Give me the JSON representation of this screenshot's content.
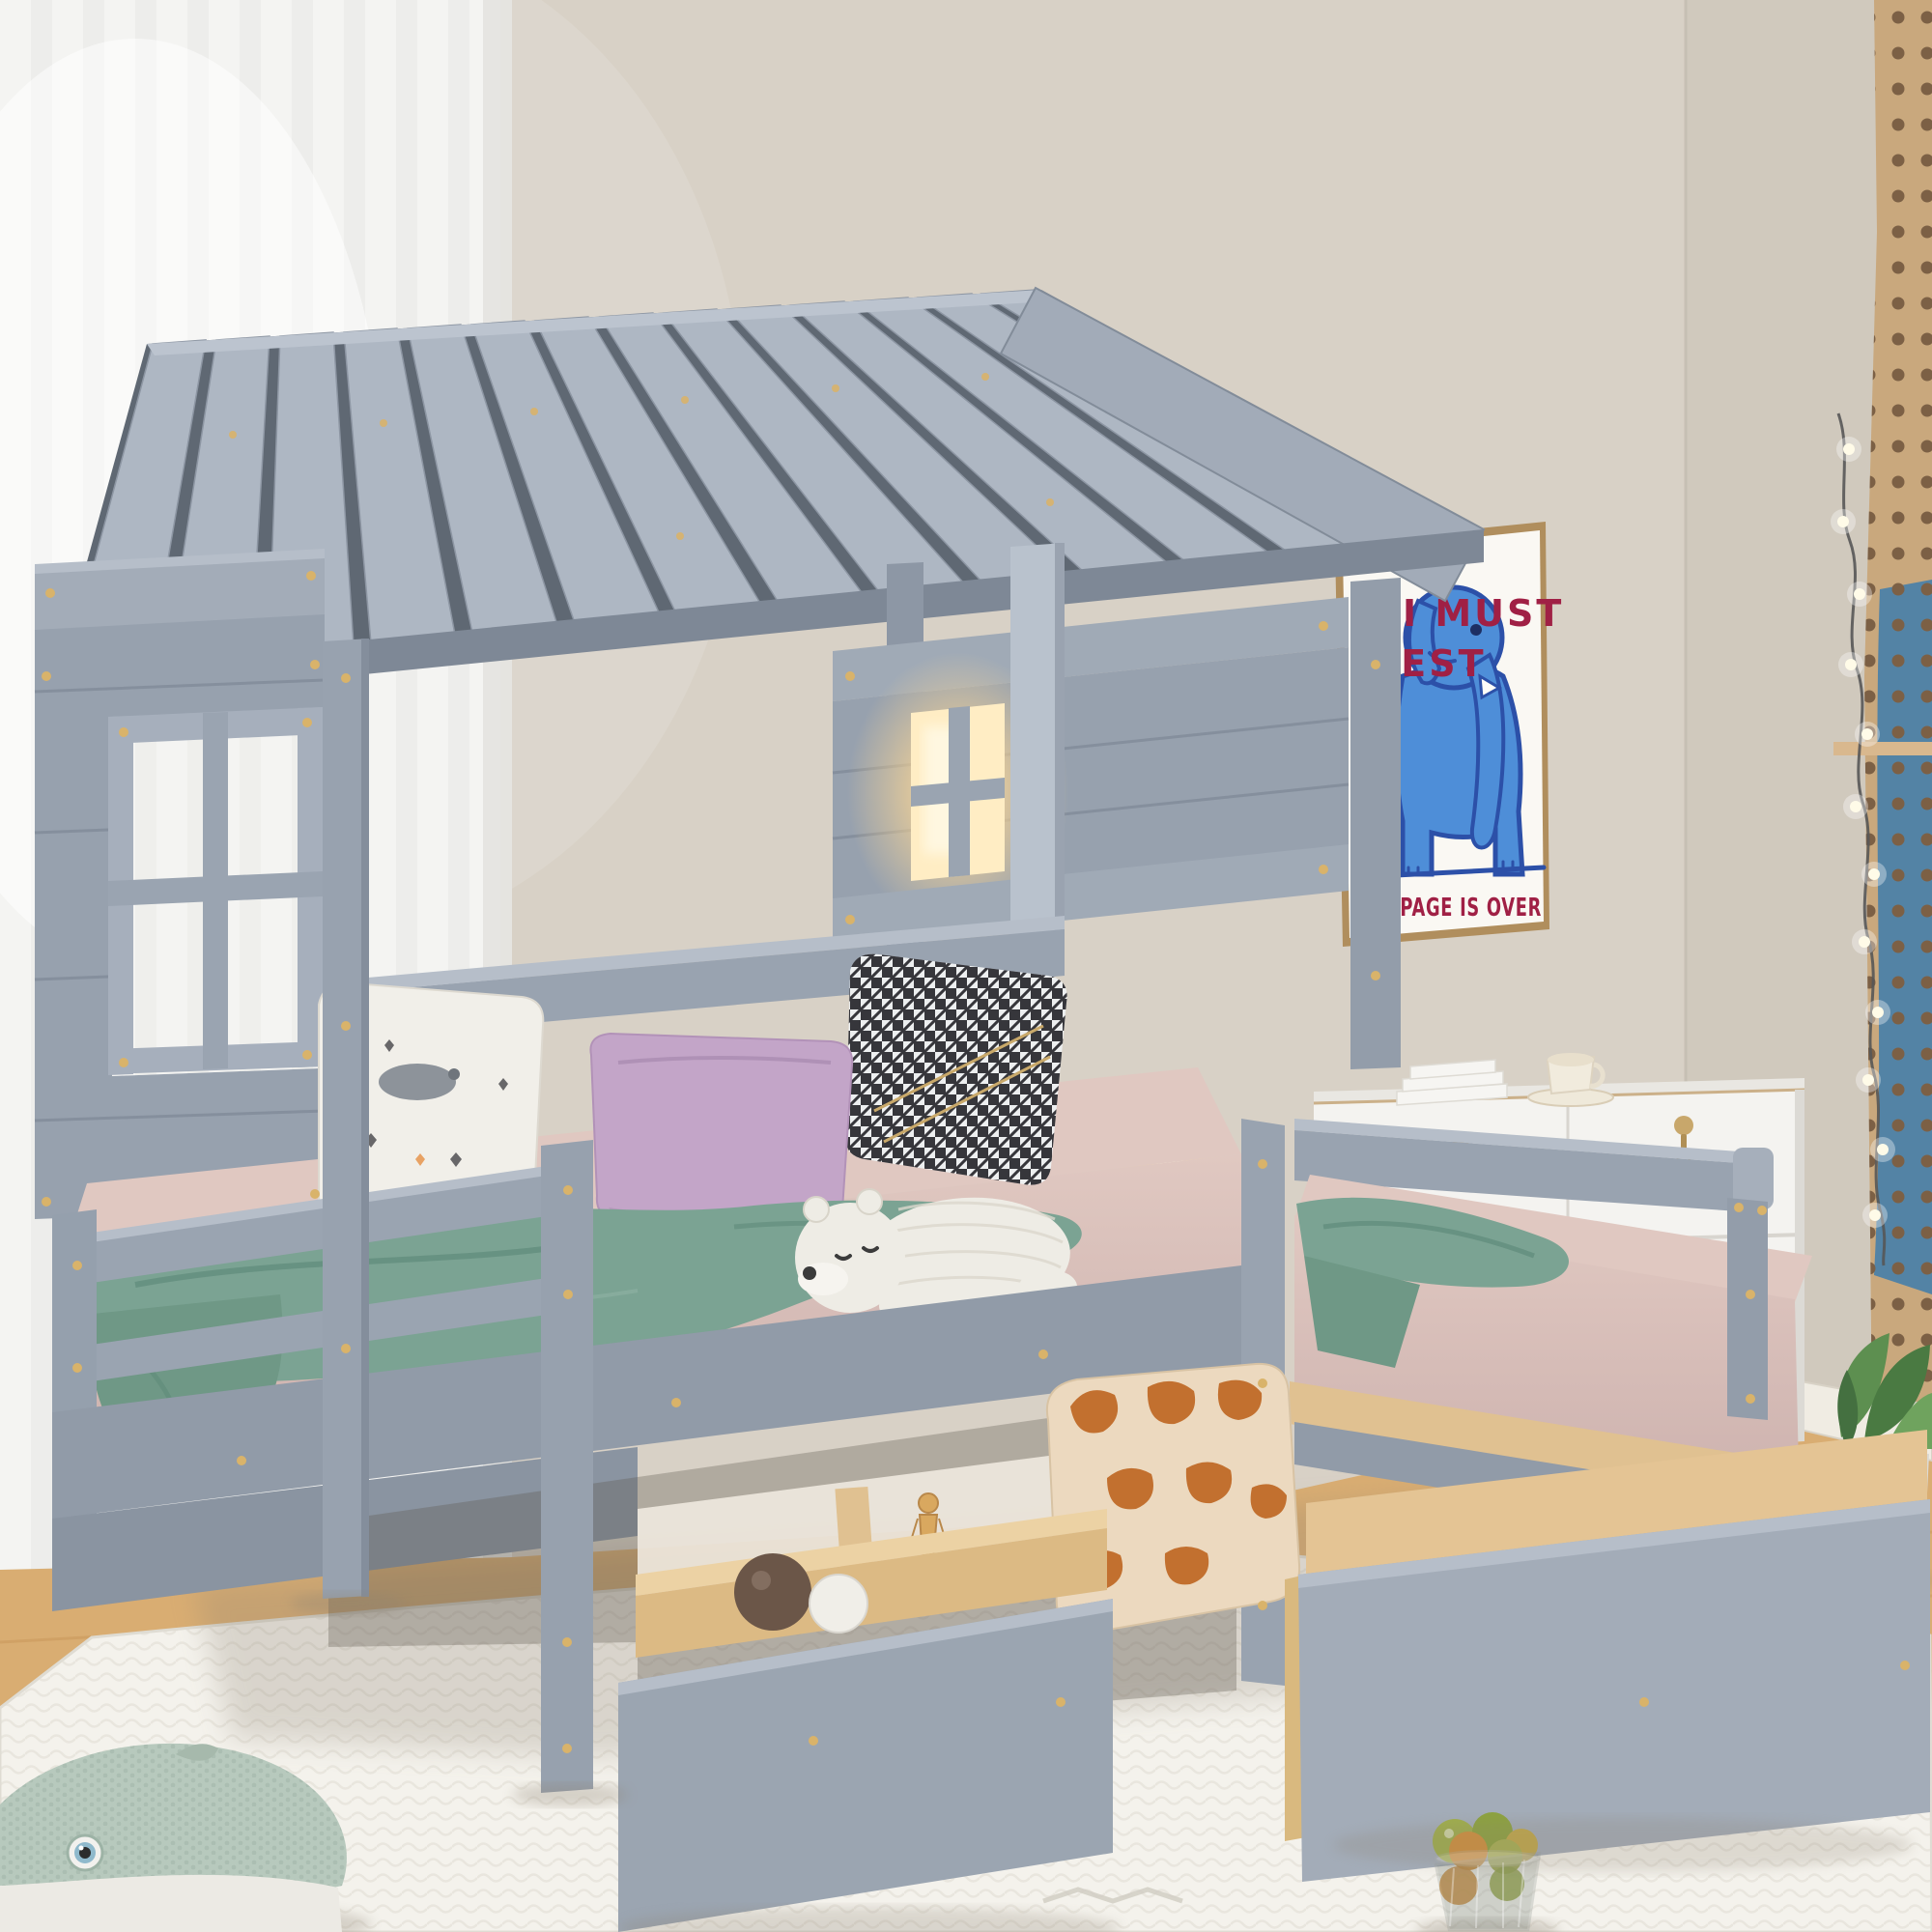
{
  "scene": {
    "type": "product-photo",
    "subject": "Gray wooden house-frame kids bed with slatted roof, guard rails and two pull-out storage drawers, staged in a bright bedroom",
    "room": "kids bedroom with sheer curtain, framed elephant poster, tan pegboard with string lights, white sideboard, oak floor and white rug"
  },
  "poster": {
    "line1": "I MUST",
    "line2": "REST",
    "line3": "RAMPAGE IS OVER",
    "artwork": "blue elephant illustration",
    "text_color": "#a02045"
  },
  "palette": {
    "wall": "#d8d1c6",
    "wall-right": "#d0c9bd",
    "curtain": "#f4f4f2",
    "frame": "#97a1ae",
    "frame-dark": "#7e8896",
    "frame-light": "#b6bec9",
    "roof-slat": "#aeb7c3",
    "roof-gap": "#5f6873",
    "mattress": "#cfb4b0",
    "mattress-light": "#e0c8c1",
    "blanket": "#7ba393",
    "blanket-dark": "#5f8a7a",
    "pillow-white": "#f1efe9",
    "lilac": "#c3a5c8",
    "hound-dark": "#26262b",
    "hound-light": "#edeff0",
    "giraffe-base": "#ecd9bf",
    "giraffe-patch": "#c2702f",
    "bear": "#eeece5",
    "wood": "#e0c191",
    "floor": "#d9ad72",
    "rug": "#f4f2ec",
    "rug-line": "#e1ded5",
    "poster-bg": "#faf8f3",
    "poster-frame": "#b08e5d",
    "poster-red": "#a02045",
    "elephant": "#4e8ed8",
    "elephant-dark": "#2c50a8",
    "pegboard": "#c9a87d",
    "peg-hole": "#7c6045",
    "sideboard": "#f4f3f0",
    "plant": "#4f7f45",
    "whale": "#b7c9bd",
    "glow": "#ffe3ae",
    "gold": "#d9b36a"
  },
  "objects": {
    "bed": "gray house-frame double twin bed with slatted roof",
    "roof_slats": 14,
    "windows": "left wall window with cross frame; right wall window with warm light glowing",
    "pillows": [
      "white animal-print pillow",
      "lilac pillow",
      "black-white houndstooth pillow",
      "giraffe-print pillow"
    ],
    "plush_toys": [
      "sleeping polar bear plush on mattress",
      "knitted whale plush on rug"
    ],
    "drawers": "two pull-out under-bed storage drawers, gray fronts with natural wood boxes",
    "drawer_contents": [
      "brown ball",
      "white ball",
      "small wooden mannequin under bed"
    ],
    "decor": [
      "framed blue elephant poster",
      "tan pegboard with string lights",
      "white sideboard with coffee cup, saucer, books, key and casters",
      "green plant in white pot",
      "glass bowl with citrus fruits",
      "white textured rug",
      "light oak floor",
      "white sheer curtain"
    ]
  }
}
